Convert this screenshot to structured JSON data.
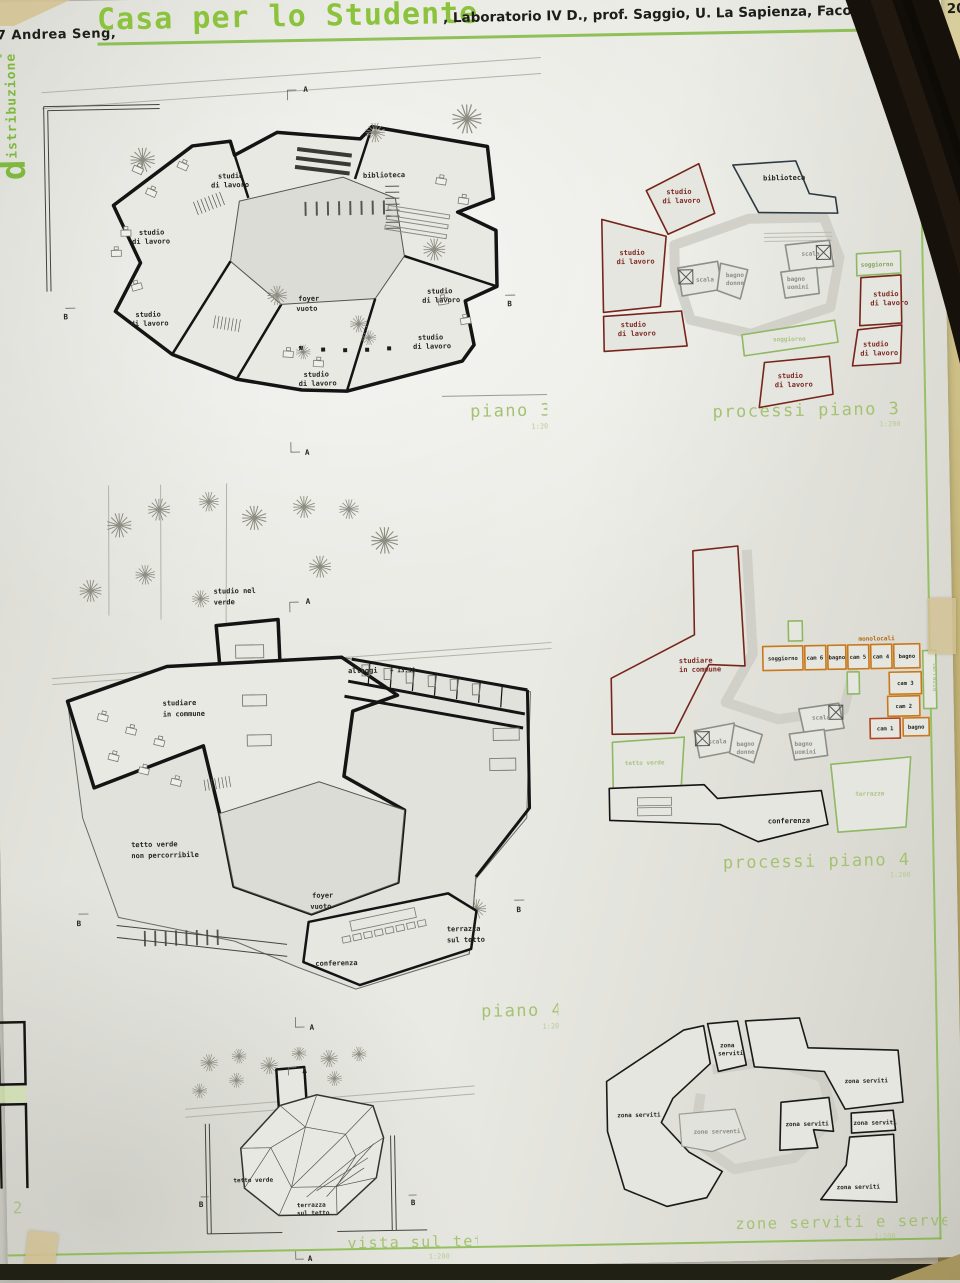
{
  "header": {
    "author": "07 Andrea Seng,",
    "title": "Casa per lo Studente",
    "meta": ", Laboratorio IV D., prof. Saggio, U. La Sapienza, Facoltà Quaroni, 200"
  },
  "side": {
    "initial": "d",
    "rest": "istribuzione"
  },
  "words": {
    "studio": "studio",
    "di_lavoro": "di lavoro",
    "biblioteca": "biblioteca",
    "foyer": "foyer",
    "vuoto": "vuoto",
    "scala": "scala",
    "bagno": "bagno",
    "donne": "donne",
    "uomini": "uomini",
    "soggiorno": "soggiorno",
    "conferenza": "conferenza",
    "terrazza": "terrazza",
    "sul_tetto": "sul tetto",
    "tetto_verde": "tetto verde",
    "non_percorribile": "non percorribile",
    "studio_nel": "studio nel",
    "verde": "verde",
    "studiare": "studiare",
    "in_commune": "in commune",
    "alloggi": "alloggi",
    "level": "+ 13.50",
    "zona_serviti": "zona serviti",
    "zona": "zona",
    "serviti": "serviti",
    "zone_serventi": "zone serventi",
    "a": "A",
    "b": "B",
    "scale": "1:200"
  },
  "titles": {
    "piano3": "piano 3",
    "processi3": "processi piano 3",
    "piano4": "piano 4",
    "processi4": "processi piano 4",
    "vista": "vista sul tetto",
    "zone": "zone serviti e serventi"
  },
  "mono": {
    "label": "monolocali",
    "rooms": [
      "soggiorno",
      "cam 6",
      "bagno",
      "cam 5",
      "cam 4",
      "bagno",
      "cam 3",
      "cam 2",
      "cam 1",
      "bagno"
    ]
  },
  "note": {
    "edge": "2"
  }
}
